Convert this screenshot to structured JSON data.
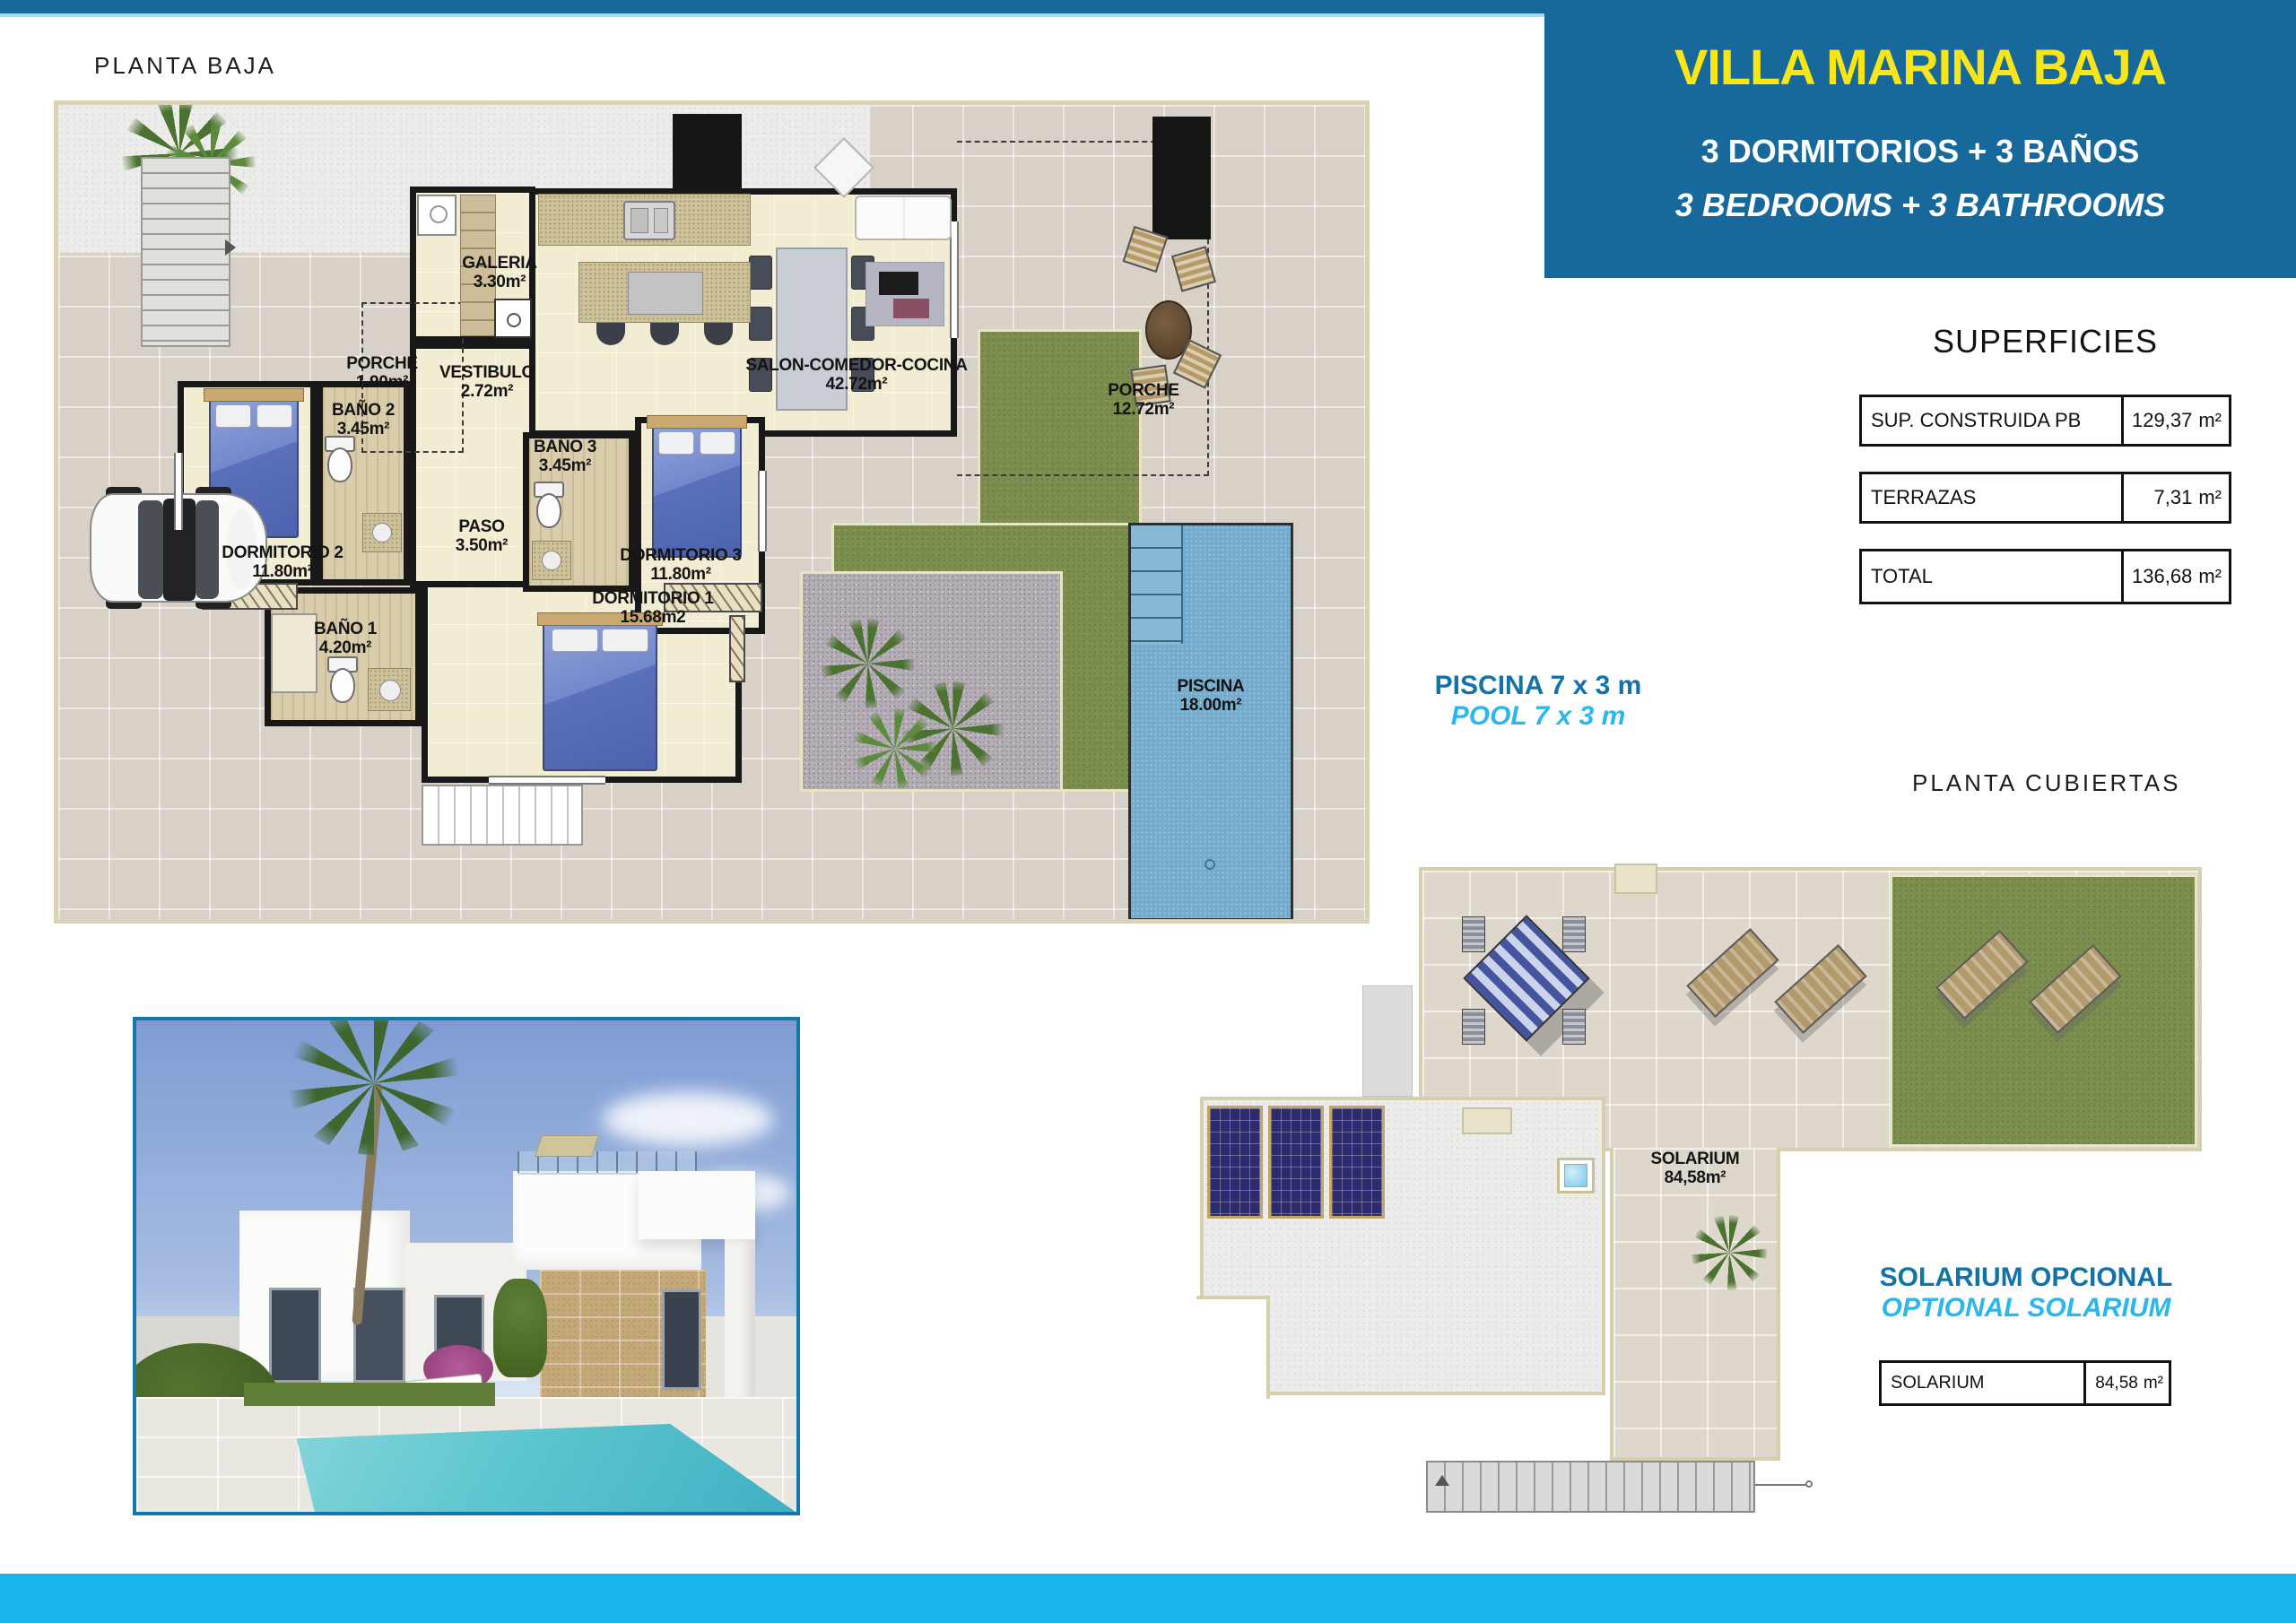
{
  "page": {
    "title_ground": "PLANTA BAJA",
    "title_roof": "PLANTA CUBIERTAS"
  },
  "header": {
    "title": "VILLA MARINA BAJA",
    "line_es": "3 DORMITORIOS + 3 BAÑOS",
    "line_en": "3 BEDROOMS + 3 BATHROOMS",
    "bg_color": "#16699a",
    "title_color": "#f8e616"
  },
  "pool_note": {
    "es": "PISCINA 7 x 3 m",
    "en": "POOL 7 x 3 m",
    "es_color": "#1273a8",
    "en_color": "#2bb7ea"
  },
  "superficies": {
    "title": "SUPERFICIES",
    "unit": "m²",
    "rows": [
      {
        "label": "SUP. CONSTRUIDA PB",
        "value": "129,37"
      },
      {
        "label": "TERRAZAS",
        "value": "7,31"
      },
      {
        "label": "TOTAL",
        "value": "136,68"
      }
    ]
  },
  "solarium": {
    "title_es": "SOLARIUM OPCIONAL",
    "title_en": "OPTIONAL SOLARIUM",
    "label": "SOLARIUM",
    "value": "84,58",
    "unit": "m²"
  },
  "rooms": {
    "galeria": {
      "name": "GALERIA",
      "area": "3.30m²"
    },
    "porche1": {
      "name": "PORCHE",
      "area": "1.90m²"
    },
    "vestibulo": {
      "name": "VESTIBULO",
      "area": "2.72m²"
    },
    "salon": {
      "name": "SALON-COMEDOR-COCINA",
      "area": "42.72m²"
    },
    "porche2": {
      "name": "PORCHE",
      "area": "12.72m²"
    },
    "bano2": {
      "name": "BAÑO 2",
      "area": "3.45m²"
    },
    "bano3": {
      "name": "BAÑO 3",
      "area": "3.45m²"
    },
    "paso": {
      "name": "PASO",
      "area": "3.50m²"
    },
    "dorm2": {
      "name": "DORMITORIO 2",
      "area": "11.80m²"
    },
    "dorm3": {
      "name": "DORMITORIO 3",
      "area": "11.80m²"
    },
    "bano1": {
      "name": "BAÑO 1",
      "area": "4.20m²"
    },
    "dorm1": {
      "name": "DORMITORIO 1",
      "area": "15.68m2"
    },
    "piscina": {
      "name": "PISCINA",
      "area": "18.00m²"
    },
    "solarium_roof": {
      "name": "SOLARIUM",
      "area": "84,58m²"
    }
  }
}
